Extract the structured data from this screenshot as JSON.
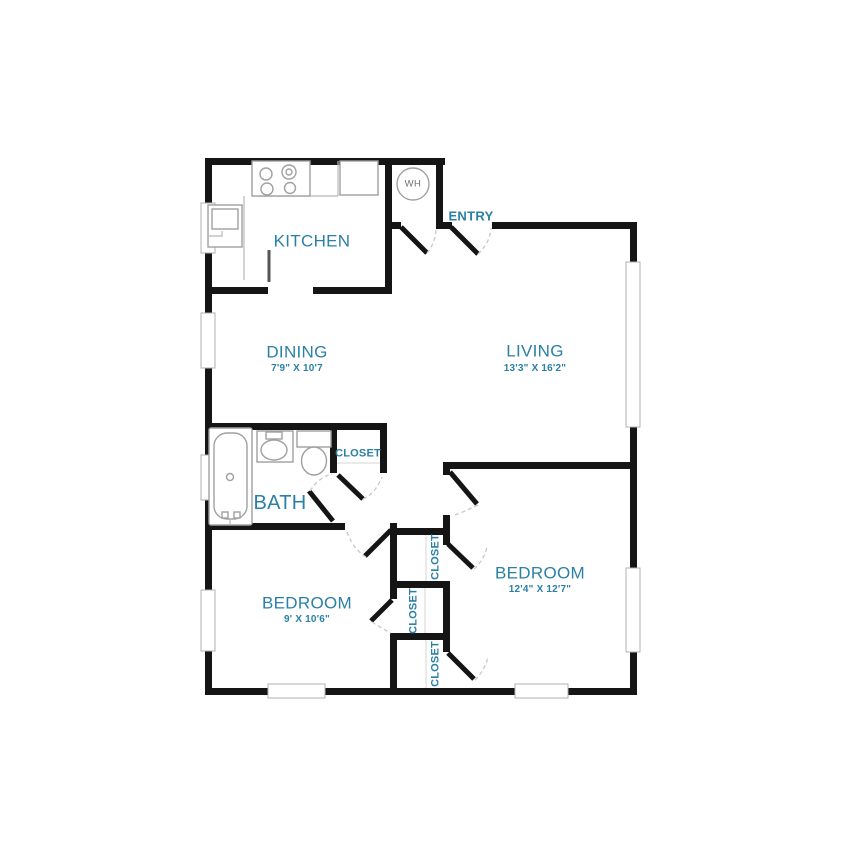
{
  "labels": {
    "kitchen": "KITCHEN",
    "entry": "ENTRY",
    "water_heater": "WH",
    "dining": "DINING",
    "dining_dims": "7'9\" X 10'7",
    "living": "LIVING",
    "living_dims": "13'3\" X 16'2\"",
    "bath": "BATH",
    "closet_hall": "CLOSET",
    "bedroom_left": "BEDROOM",
    "bedroom_left_dims": "9' X 10'6\"",
    "bedroom_right": "BEDROOM",
    "bedroom_right_dims": "12'4\" X 12'7\"",
    "closet_top": "CLOSET",
    "closet_middle": "CLOSET",
    "closet_bottom": "CLOSET"
  },
  "colors": {
    "label_blue": "#2a80a6",
    "wall_black": "#151515"
  }
}
